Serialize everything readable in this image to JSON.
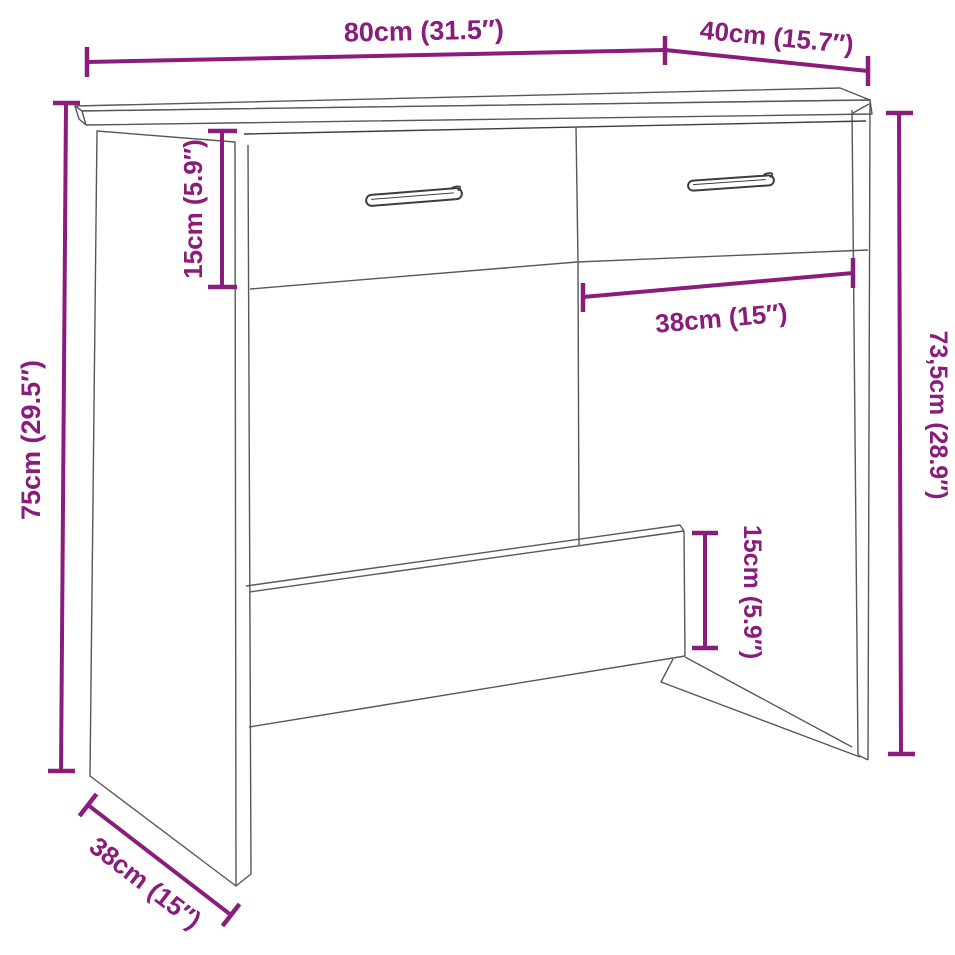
{
  "figure": {
    "type": "product-dimension-drawing",
    "subject": "desk-with-two-drawers",
    "background_color": "#ffffff",
    "accent_color": "#8a1c7c",
    "line_color": "#585858",
    "dimensions": [
      {
        "id": "top-width",
        "label": "80cm (31.5″)",
        "orientation": "horizontal"
      },
      {
        "id": "top-depth",
        "label": "40cm (15.7″)",
        "orientation": "horizontal-sloped"
      },
      {
        "id": "drawer-height",
        "label": "15cm (5.9″)",
        "orientation": "vertical"
      },
      {
        "id": "overall-height",
        "label": "75cm (29.5″)",
        "orientation": "vertical"
      },
      {
        "id": "drawer-width",
        "label": "38cm (15″)",
        "orientation": "horizontal-sloped"
      },
      {
        "id": "side-height",
        "label": "73,5cm (28.9″)",
        "orientation": "vertical"
      },
      {
        "id": "back-panel-height",
        "label": "15cm (5.9″)",
        "orientation": "vertical"
      },
      {
        "id": "bottom-depth",
        "label": "38cm (15″)",
        "orientation": "diagonal"
      }
    ]
  }
}
